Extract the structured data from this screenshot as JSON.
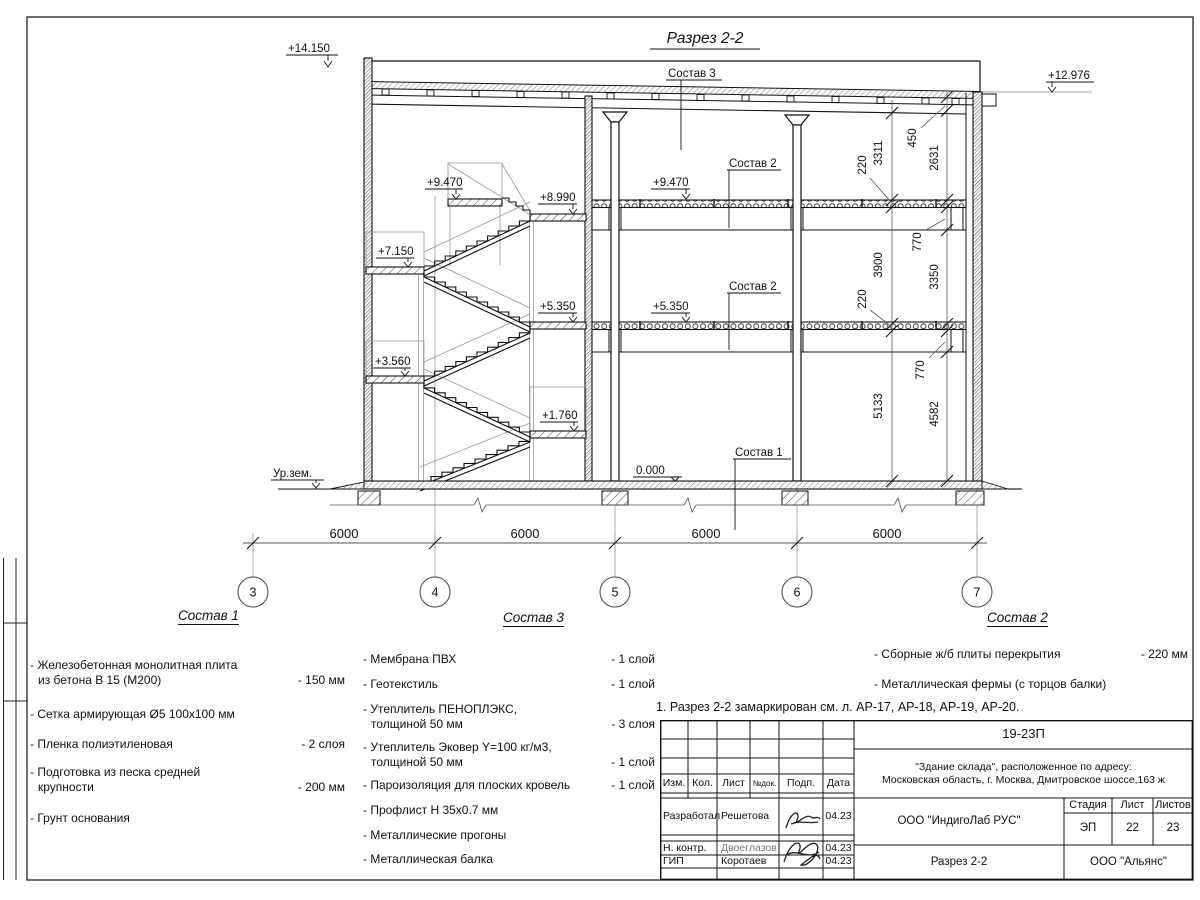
{
  "drawing": {
    "title": "Разрез 2-2",
    "elev": {
      "roof_left": "+14.150",
      "roof_right": "+12.976",
      "f9470": "+9.470",
      "f8990": "+8.990",
      "f7150": "+7.150",
      "f5350": "+5.350",
      "f3560": "+3.560",
      "f1760": "+1.760",
      "zero": "0.000",
      "ground": "Ур.зем."
    },
    "callouts": {
      "c1": "Состав 1",
      "c2": "Состав 2",
      "c3": "Состав 3"
    },
    "dims": {
      "inner": [
        "220",
        "3311",
        "220",
        "3900",
        "5133"
      ],
      "outer": [
        "450",
        "2631",
        "770",
        "3350",
        "770",
        "4582"
      ],
      "spans": [
        "6000",
        "6000",
        "6000",
        "6000"
      ],
      "axes": [
        "3",
        "4",
        "5",
        "6",
        "7"
      ]
    }
  },
  "legend1": {
    "title": "Состав 1",
    "items": [
      {
        "l1": "- Железобетонная  монолитная плита",
        "l2": "из бетона В 15 (М200)",
        "v": "- 150 мм"
      },
      {
        "l1": "- Сетка армирующая Ø5 100х100 мм",
        "l2": "",
        "v": ""
      },
      {
        "l1": "- Пленка полиэтиленовая",
        "l2": "",
        "v": "-  2 слоя"
      },
      {
        "l1": "- Подготовка из песка средней",
        "l2": "крупности",
        "v": "- 200 мм"
      },
      {
        "l1": "- Грунт основания",
        "l2": "",
        "v": ""
      }
    ]
  },
  "legend3": {
    "title": "Состав 3",
    "items": [
      {
        "l1": "- Мембрана ПВХ",
        "l2": "",
        "v": "- 1 слой"
      },
      {
        "l1": "- Геотекстиль",
        "l2": "",
        "v": "- 1 слой"
      },
      {
        "l1": "- Утеплитель ПЕНОПЛЭКС,",
        "l2": "толщиной 50 мм",
        "v": "- 3 слоя"
      },
      {
        "l1": "- Утеплитель Эковер Y=100 кг/м3,",
        "l2": "толщиной 50 мм",
        "v": "- 1 слой"
      },
      {
        "l1": "- Пароизоляция для плоских кровель",
        "l2": "",
        "v": "- 1 слой"
      },
      {
        "l1": "- Профлист Н 35х0.7 мм",
        "l2": "",
        "v": ""
      },
      {
        "l1": "- Металлические прогоны",
        "l2": "",
        "v": ""
      },
      {
        "l1": "- Металлическая балка",
        "l2": "",
        "v": ""
      }
    ]
  },
  "legend2": {
    "title": "Состав 2",
    "items": [
      {
        "l1": "- Сборные ж/б плиты перекрытия",
        "l2": "",
        "v": "- 220 мм"
      },
      {
        "l1": "- Металлическая фермы (с торцов балки)",
        "l2": "",
        "v": ""
      }
    ]
  },
  "note": "1. Разрез 2-2 замаркирован см. л. АР-17, АР-18, АР-19, АР-20.",
  "stamp": {
    "doc": "19-23П",
    "object1": "\"Здание склада\", расположенное по адресу:",
    "object2": "Московская область, г. Москва, Дмитровское шоссе,163 ж",
    "org": "ООО \"ИндигоЛаб РУС\"",
    "drawing_name": "Разрез 2-2",
    "contractor": "ООО \"Альянс\"",
    "stage_label": "Стадия",
    "sheet_label": "Лист",
    "sheets_label": "Листов",
    "stage": "ЭП",
    "sheet": "22",
    "sheets": "23",
    "h_izm": "Изм.",
    "h_kol": "Кол.",
    "h_list": "Лист",
    "h_doc": "№док.",
    "h_sign": "Подп.",
    "h_date": "Дата",
    "r1_role": "Разработал",
    "r1_name": "Решетова",
    "r1_date": "04.23",
    "r2_role": "Н. контр.",
    "r2_name": "Двоеглазов",
    "r2_date": "04.23",
    "r3_role": "ГИП",
    "r3_name": "Коротаев",
    "r3_date": "04.23"
  }
}
